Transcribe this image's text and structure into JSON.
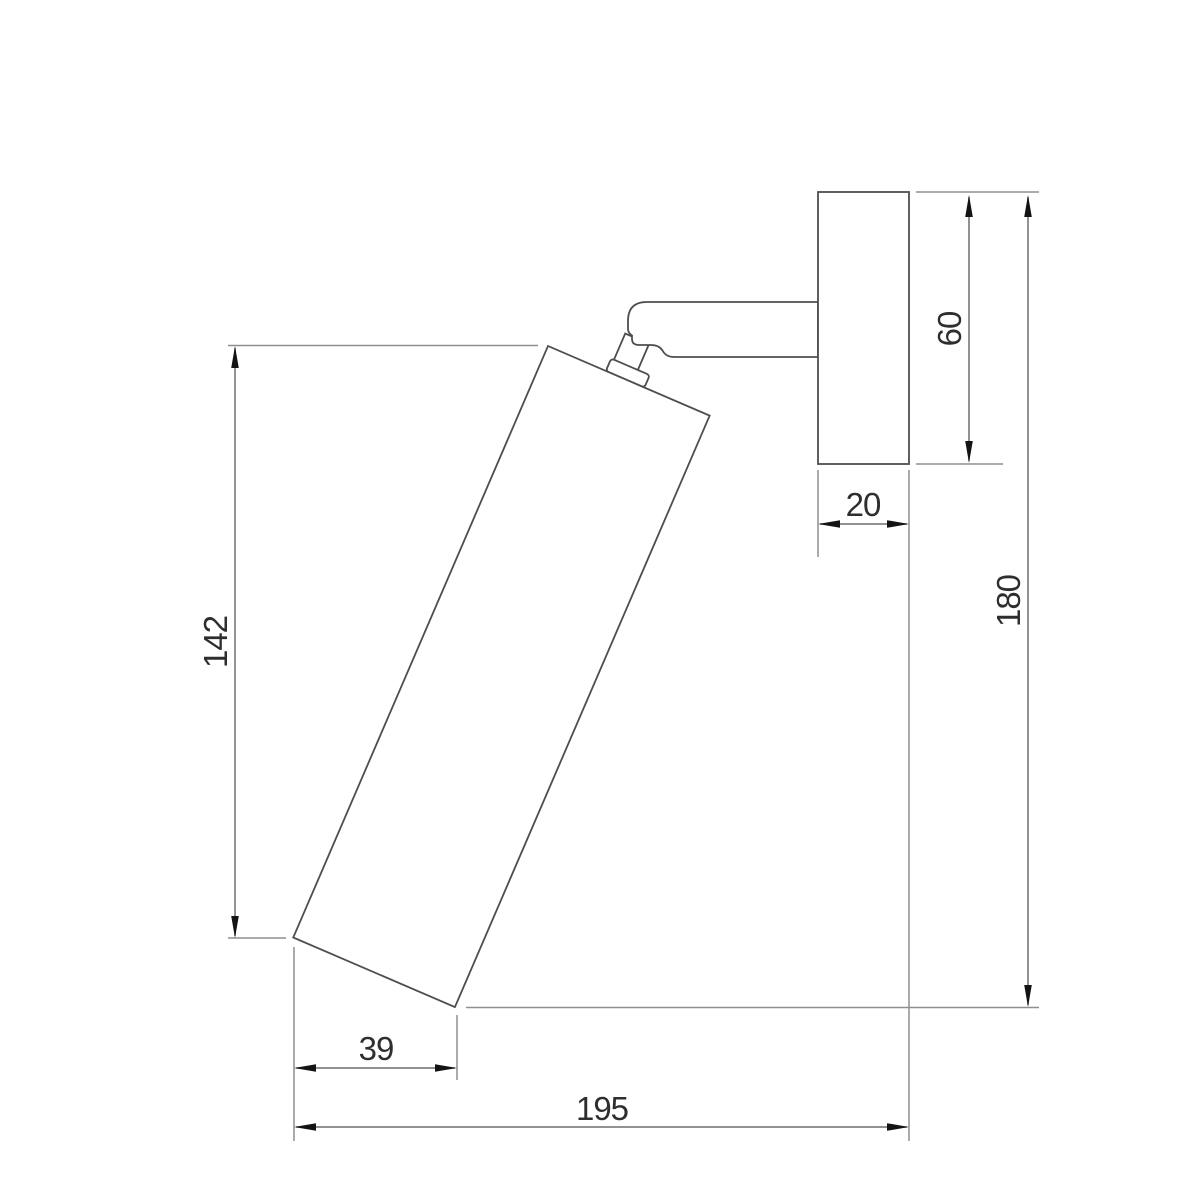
{
  "drawing": {
    "dimensions": {
      "lamp_body_vertical_height": {
        "value": "142",
        "orientation": "vertical"
      },
      "lamp_body_bottom_offset": {
        "value": "39",
        "orientation": "horizontal"
      },
      "total_depth_from_wall": {
        "value": "195",
        "orientation": "horizontal"
      },
      "wall_plate_depth": {
        "value": "20",
        "orientation": "horizontal"
      },
      "wall_plate_height": {
        "value": "60",
        "orientation": "vertical"
      },
      "total_height": {
        "value": "180",
        "orientation": "vertical"
      }
    },
    "colors": {
      "background": "#ffffff",
      "object_line": "#4e4e4e",
      "extension_line": "#8f8f8f",
      "dimension_line": "#6e6e6e",
      "arrowhead": "#141414",
      "text": "#2e2e2e"
    }
  }
}
